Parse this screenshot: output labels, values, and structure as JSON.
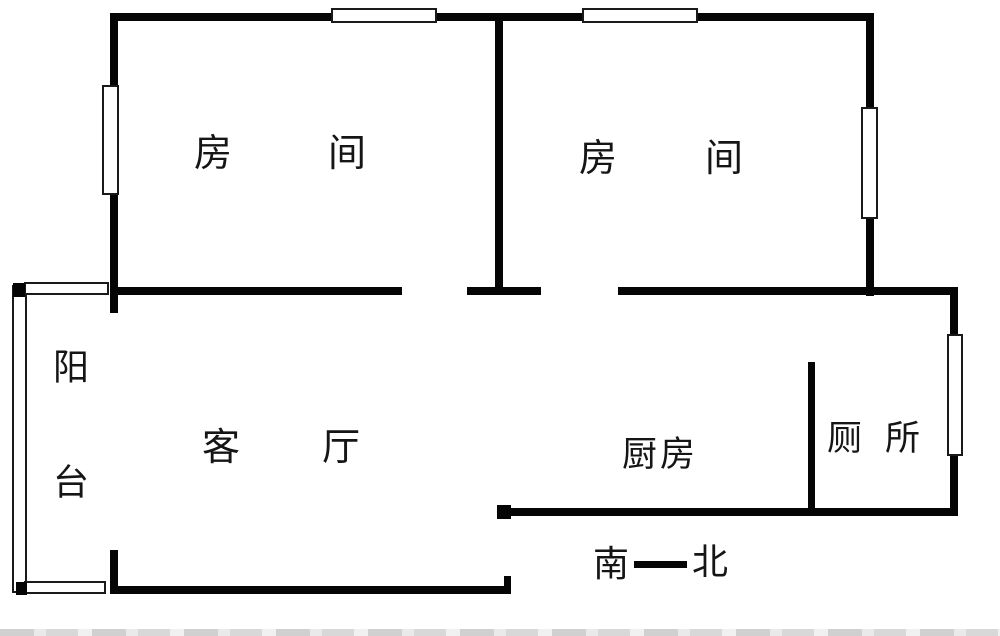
{
  "plan": {
    "type": "floor-plan",
    "background": "#ffffff",
    "wall_color": "#050505",
    "rooms": [
      {
        "id": "bedroom-1",
        "label": "房间"
      },
      {
        "id": "bedroom-2",
        "label": "房间"
      },
      {
        "id": "balcony",
        "label": "阳台"
      },
      {
        "id": "living-room",
        "label": "客厅"
      },
      {
        "id": "kitchen",
        "label": "厨房"
      },
      {
        "id": "toilet",
        "label": "厕所"
      }
    ],
    "compass": {
      "south": "南",
      "north": "北"
    }
  },
  "geometry": {
    "walls": [
      {
        "name": "wall-top-exterior",
        "x": 110,
        "y": 13,
        "w": 764,
        "h": 8
      },
      {
        "name": "wall-bedroom1-left",
        "x": 110,
        "y": 13,
        "w": 8,
        "h": 300
      },
      {
        "name": "wall-bedrooms-divider",
        "x": 495,
        "y": 13,
        "w": 8,
        "h": 281
      },
      {
        "name": "wall-bedroom2-right",
        "x": 866,
        "y": 13,
        "w": 8,
        "h": 283
      },
      {
        "name": "wall-interior-left-segment",
        "x": 110,
        "y": 287,
        "w": 292,
        "h": 8
      },
      {
        "name": "wall-interior-mid-segment",
        "x": 467,
        "y": 287,
        "w": 74,
        "h": 8
      },
      {
        "name": "wall-interior-right-segment",
        "x": 618,
        "y": 287,
        "w": 340,
        "h": 8
      },
      {
        "name": "wall-toilet-right",
        "x": 950,
        "y": 287,
        "w": 8,
        "h": 227
      },
      {
        "name": "wall-kitchen-toilet-divider",
        "x": 808,
        "y": 362,
        "w": 7,
        "h": 152
      },
      {
        "name": "wall-kitchen-bottom",
        "x": 504,
        "y": 508,
        "w": 454,
        "h": 8
      },
      {
        "name": "door-post-kitchen-corner",
        "x": 497,
        "y": 505,
        "w": 14,
        "h": 14
      },
      {
        "name": "wall-living-bottom",
        "x": 110,
        "y": 586,
        "w": 401,
        "h": 8
      },
      {
        "name": "door-jamb-entry",
        "x": 504,
        "y": 576,
        "w": 7,
        "h": 18
      },
      {
        "name": "wall-balcony-right-stub",
        "x": 110,
        "y": 550,
        "w": 8,
        "h": 44
      },
      {
        "name": "compass-line",
        "x": 634,
        "y": 561,
        "w": 53,
        "h": 7
      }
    ],
    "windows": [
      {
        "name": "window-top-left",
        "x": 331,
        "y": 8,
        "w": 106,
        "h": 15
      },
      {
        "name": "window-top-right",
        "x": 582,
        "y": 8,
        "w": 116,
        "h": 15
      },
      {
        "name": "window-bedroom1-left",
        "x": 102,
        "y": 85,
        "w": 17,
        "h": 110
      },
      {
        "name": "window-bedroom2-right",
        "x": 861,
        "y": 107,
        "w": 17,
        "h": 112
      },
      {
        "name": "window-toilet-right",
        "x": 947,
        "y": 334,
        "w": 16,
        "h": 122
      },
      {
        "name": "balcony-rail-left",
        "x": 12,
        "y": 285,
        "w": 15,
        "h": 308
      },
      {
        "name": "balcony-window-top",
        "x": 24,
        "y": 282,
        "w": 85,
        "h": 13
      },
      {
        "name": "balcony-window-bottom",
        "x": 24,
        "y": 581,
        "w": 82,
        "h": 13
      }
    ],
    "marks": [
      {
        "name": "balcony-corner-block-top",
        "x": 13,
        "y": 283,
        "w": 12,
        "h": 14
      },
      {
        "name": "balcony-corner-block-bottom",
        "x": 16,
        "y": 582,
        "w": 11,
        "h": 13
      }
    ]
  }
}
